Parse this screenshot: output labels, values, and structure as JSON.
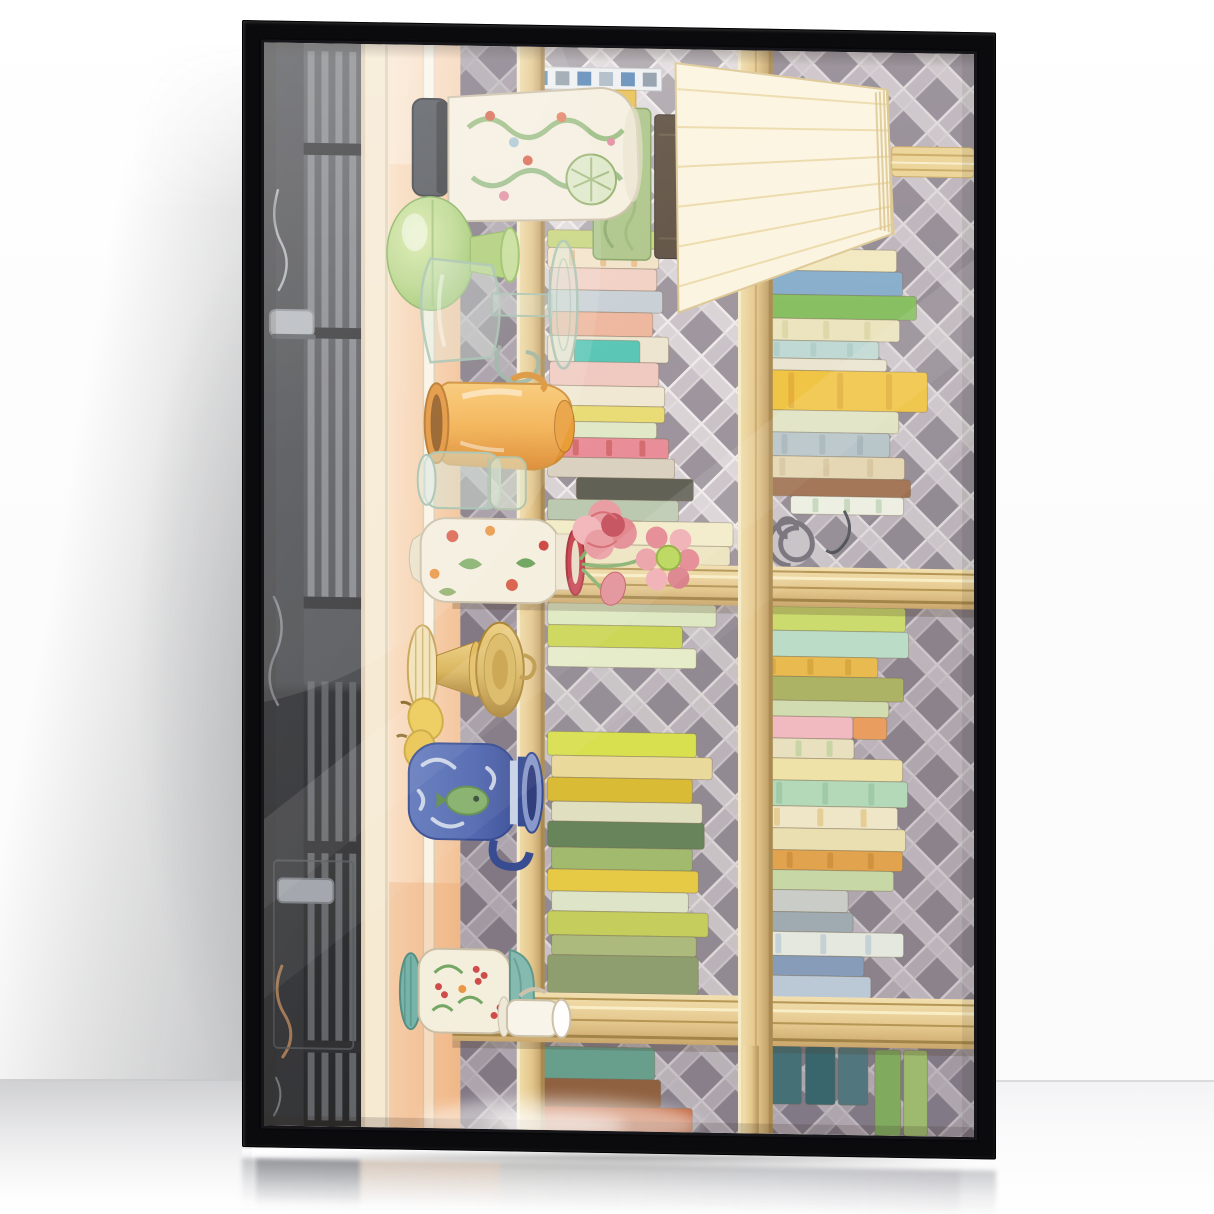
{
  "scene": {
    "type": "framed-art-print-mockup-photo",
    "description": "A tall black floater frame leans against a soft-white wall on a glossy reflective floor. A diffuse shadow falls on the wall to the left of the frame and the frame reflects in the floor below. Behind the glass is a pastel watercolor still life of a bookshelf, printed rotated 90 degrees: stacks of pastel books, a pleated cream lampshade, ceramic and glass vases, pink peonies, a brass candlestick and a blue-and-white jar against a lavender-gray diagonal lattice wall, with a dark cabinet band and a peach shelf surface along one side. Diagonal window glare streaks across the glass.",
    "room": {
      "wall_color": "#fdfdfd",
      "wall_shadow_color": "#46484d",
      "floor_color": "#f3f3f5",
      "floor_line_y_px": 1080,
      "floor_is_reflective": true
    },
    "frame": {
      "style": "black floater frame with glass",
      "color": "#0b0b0d",
      "orientation": "portrait, leaning with slight perspective skew",
      "glare_on_glass": true
    },
    "artwork": {
      "medium": "watercolor illustration",
      "rotation": "image printed sideways (rotated 90 degrees)",
      "objects": [
        "dark cabinet band with louvered stripes, metal handles and wrought-iron scrolls",
        "cream wall strip and peach shelf band with cream pinstripe",
        "white ginger jar with green foliage pattern and dark lid",
        "blue-and-white checkered box",
        "green marbled tall book",
        "round green glass vase",
        "clear glass pedestal pitcher",
        "orange ceramic jug",
        "two clear storage jars",
        "white floral vase with red rim holding pink peonies and a bud",
        "brass candlestick with drip dish",
        "two small yellow gourds",
        "blue-and-white ceramic jar with green fish motif",
        "teal-footed vase with berry-and-leaf pattern",
        "white teacup",
        "pleated cream lampshade with striped wooden stand",
        "gray metal scroll ornament",
        "wooden shelf planks, beams and divider",
        "diagonal lattice wallpaper background",
        "stacked pastel books"
      ],
      "palette": {
        "wall": "#fdfdfd",
        "floor": "#f3f3f5",
        "frame": "#0b0b0d",
        "paper": "#f6ecd9",
        "lat-base": "#bdb5be",
        "lat-light": "#d8d2d7",
        "lat-mid": "#c7bfc7",
        "lat-dark": "#978f9a",
        "grout": "#efeaec",
        "wood-light": "#f2dfae",
        "wood": "#e2c488",
        "wood-dark": "#b2905a",
        "dark-band": "#3e4147",
        "band-stripe": "#81848a",
        "cream-strip": "#f6ead4",
        "peach": "#f6d2ae",
        "peach-deep": "#e89a5e",
        "pinstripe": "#faf5e8",
        "shade": "#fbf5e2",
        "shade-stripe": "#e9d49c",
        "apple": "#b4d687",
        "apple-deep": "#8cba55",
        "jug": "#f3ab43",
        "jug-deep": "#d97f1f",
        "glass": "#9fbfae",
        "vase-white": "#f5f0e1",
        "floral-green": "#7fae68",
        "floral-red": "#d95f4a",
        "gold": "#d9b45a",
        "gold-deep": "#a87f2e",
        "blue-jar": "#4a63b2",
        "blue-jar-deep": "#2e4490",
        "jar-pattern": "#dfe6f2",
        "teal-foot": "#6fb0a8",
        "rose": "#e89aa2",
        "rose-deep": "#c4505e",
        "lime": "#b5d44f"
      },
      "books": {
        "left_top": [
          [
            286,
            183,
            150,
            18,
            "#c3d476"
          ],
          [
            286,
            201,
            112,
            20,
            "#f2e3c8",
            "#e0a060"
          ],
          [
            288,
            221,
            108,
            22,
            "#f2cfc4"
          ],
          [
            286,
            243,
            116,
            22,
            "#c6ced6"
          ],
          [
            290,
            265,
            102,
            24,
            "#eeb49a"
          ],
          [
            286,
            289,
            122,
            26,
            "#ede4d0"
          ],
          [
            313,
            293,
            66,
            24,
            "#4fc4b4"
          ],
          [
            288,
            315,
            110,
            24,
            "#f0c8c0"
          ],
          [
            286,
            339,
            118,
            20,
            "#f0e8d2"
          ],
          [
            300,
            359,
            104,
            16,
            "#e8dc70"
          ],
          [
            286,
            375,
            110,
            16,
            "#dfe8c8"
          ],
          [
            288,
            391,
            120,
            20,
            "#e88a96",
            "#c04848"
          ],
          [
            286,
            411,
            128,
            20,
            "#d8d0c0"
          ],
          [
            315,
            431,
            118,
            22,
            "#5a5a50"
          ],
          [
            286,
            453,
            132,
            21,
            "#b8c8b0"
          ],
          [
            283,
            474,
            190,
            24,
            "#f2ecca"
          ],
          [
            286,
            498,
            184,
            19,
            "#ede4be"
          ]
        ],
        "right_top": [
          [
            483,
            176,
            86,
            22,
            "#f09f88"
          ],
          [
            486,
            198,
            152,
            22,
            "#f2e8c0"
          ],
          [
            496,
            220,
            148,
            24,
            "#7fa9cc"
          ],
          [
            498,
            244,
            160,
            24,
            "#7dbb57"
          ],
          [
            493,
            268,
            148,
            22,
            "#e9e3bd",
            "#d2ca92"
          ],
          [
            488,
            290,
            132,
            18,
            "#bcd8d4",
            "#9cc4be"
          ],
          [
            488,
            308,
            140,
            12,
            "#e8e4d0"
          ],
          [
            493,
            320,
            176,
            40,
            "#f0c23c",
            "#d89a28"
          ],
          [
            490,
            360,
            150,
            22,
            "#dfe3c2"
          ],
          [
            495,
            382,
            136,
            24,
            "#b3c2c8",
            "#8fa4ac"
          ],
          [
            488,
            406,
            158,
            22,
            "#e3d4b0",
            "#c8b48a"
          ],
          [
            504,
            428,
            148,
            18,
            "#9a6a4a"
          ],
          [
            531,
            446,
            114,
            18,
            "#eef0e4",
            "#9cc49c"
          ]
        ],
        "left_bottom": [
          [
            286,
            557,
            170,
            22,
            "#dce8c0"
          ],
          [
            286,
            579,
            136,
            22,
            "#c8d44a"
          ],
          [
            286,
            601,
            150,
            20,
            "#e4ecc8"
          ],
          [
            286,
            686,
            150,
            24,
            "#d6e04a"
          ],
          [
            290,
            710,
            162,
            22,
            "#e8d898"
          ],
          [
            286,
            732,
            146,
            24,
            "#d8b92f"
          ],
          [
            290,
            756,
            152,
            20,
            "#dfe0c0"
          ],
          [
            286,
            776,
            158,
            26,
            "#5f7f55"
          ],
          [
            290,
            802,
            142,
            22,
            "#9cb86a"
          ],
          [
            286,
            824,
            152,
            22,
            "#e5c93f"
          ],
          [
            290,
            846,
            138,
            20,
            "#dce4c8"
          ],
          [
            286,
            866,
            162,
            24,
            "#c2cc58"
          ],
          [
            290,
            890,
            146,
            20,
            "#a8b87a"
          ],
          [
            286,
            910,
            152,
            38,
            "#8a9a6a"
          ]
        ],
        "right_bottom": [
          [
            483,
            557,
            164,
            24,
            "#cadb6a"
          ],
          [
            478,
            581,
            172,
            26,
            "#b8ddc8"
          ],
          [
            483,
            607,
            136,
            20,
            "#e8b84a",
            "#c8942a"
          ],
          [
            483,
            627,
            162,
            24,
            "#a8b060"
          ],
          [
            486,
            651,
            144,
            16,
            "#d0dcb0"
          ],
          [
            498,
            667,
            96,
            22,
            "#f0b8c0"
          ],
          [
            594,
            667,
            34,
            22,
            "#e89a5a"
          ],
          [
            483,
            689,
            112,
            20,
            "#e8e0c0",
            "#aac88a"
          ],
          [
            486,
            709,
            158,
            22,
            "#efe2a8"
          ],
          [
            483,
            731,
            166,
            26,
            "#b0d8b8",
            "#8abc98"
          ],
          [
            483,
            757,
            156,
            22,
            "#efe6c8",
            "#d8b86a"
          ],
          [
            483,
            779,
            164,
            22,
            "#e8dfb0"
          ],
          [
            498,
            801,
            146,
            20,
            "#e0a048",
            "#c07f2a"
          ],
          [
            483,
            821,
            152,
            20,
            "#c5d6a5"
          ],
          [
            483,
            841,
            106,
            22,
            "#c8ccc8"
          ],
          [
            498,
            863,
            96,
            20,
            "#9aa8b0"
          ],
          [
            483,
            883,
            162,
            24,
            "#e4e8e0",
            "#a8bcd0"
          ],
          [
            483,
            907,
            122,
            20,
            "#8098b8"
          ],
          [
            490,
            927,
            122,
            22,
            "#b8c8d8"
          ]
        ],
        "bottom_row": [
          [
            268,
            1002,
            126,
            32,
            "#5f9a8a"
          ],
          [
            270,
            1034,
            130,
            28,
            "#8a5a3a"
          ],
          [
            268,
            1062,
            164,
            24,
            "#c06038"
          ],
          [
            508,
            998,
            34,
            58,
            "#3a6a72"
          ],
          [
            546,
            998,
            30,
            58,
            "#2f5f68"
          ],
          [
            579,
            998,
            30,
            58,
            "#48707a"
          ],
          [
            616,
            1000,
            26,
            86,
            "#7aa85a"
          ],
          [
            645,
            1000,
            24,
            86,
            "#98b86a"
          ]
        ]
      },
      "glare": {
        "style": "large soft upper-left glare plus a crisp diagonal band and a bright streak near the bottom",
        "color": "#ffffff"
      }
    }
  }
}
